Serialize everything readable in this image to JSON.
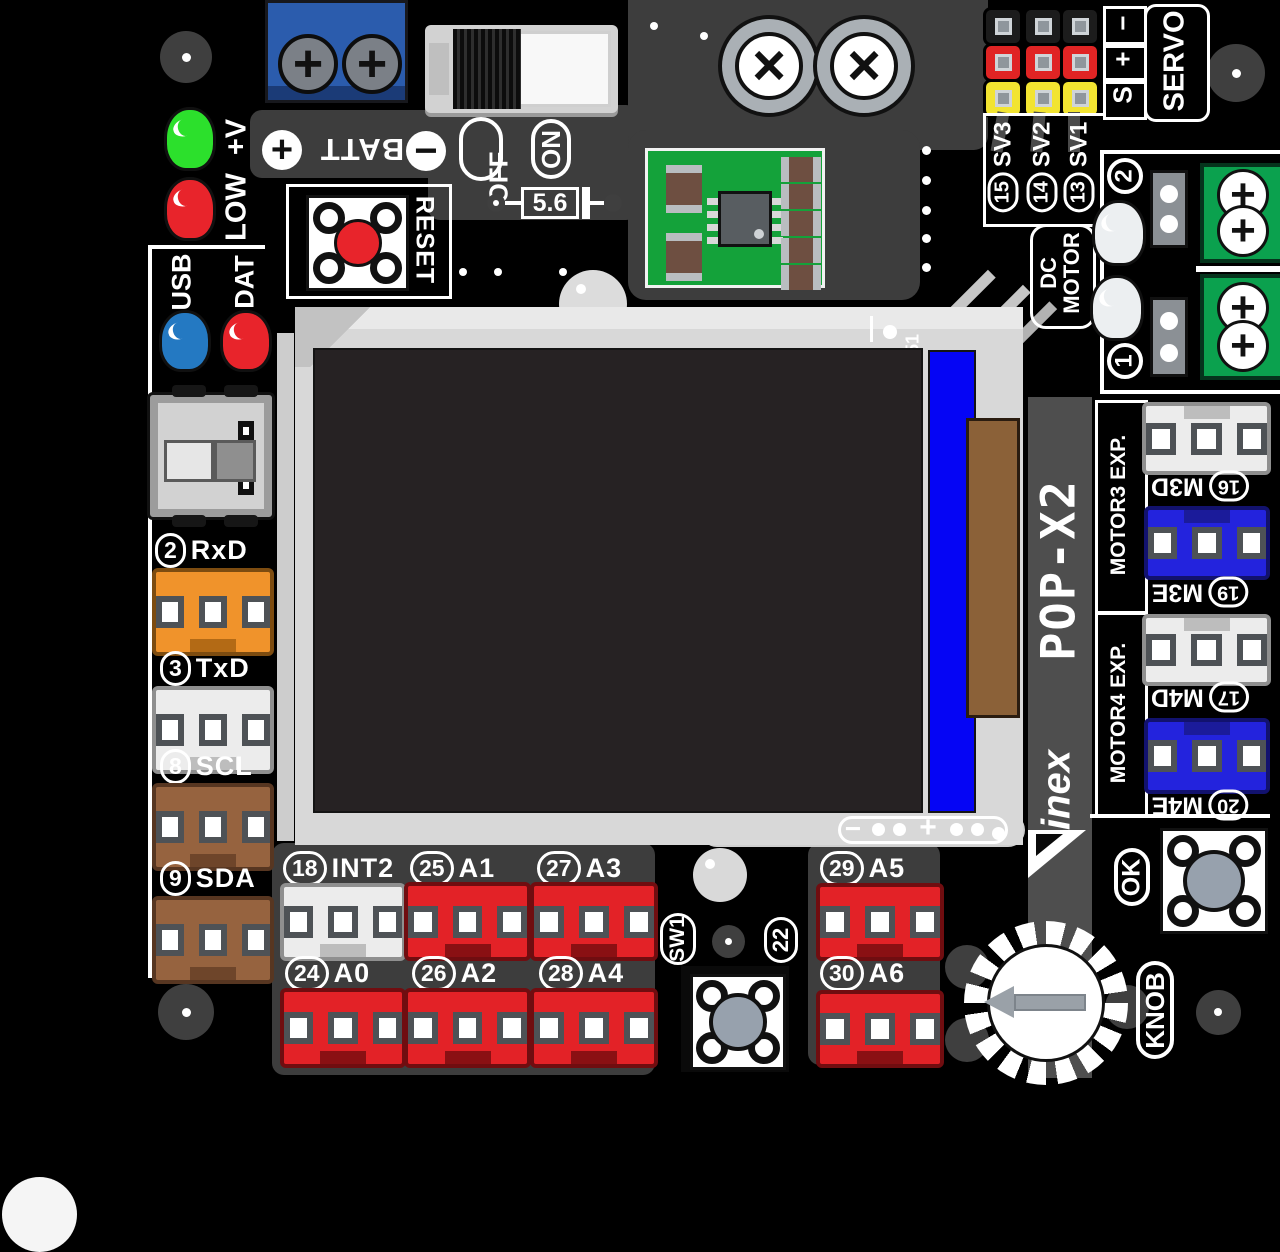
{
  "board": {
    "model": "POP-X2",
    "vendor": "inex",
    "lcd_pin": "51"
  },
  "icons": {
    "plus": "+",
    "minus": "−",
    "screw_cross": "+",
    "cap_cross": "×"
  },
  "power": {
    "batt": "BATT",
    "off": "OFF",
    "on": "ON",
    "diode_value": "5.6",
    "reset": "RESET"
  },
  "leds": {
    "vplus": "+V",
    "low": "LOW",
    "usb": "USB",
    "dat": "DAT"
  },
  "left_ports": [
    {
      "num": "2",
      "name": "RxD"
    },
    {
      "num": "3",
      "name": "TxD"
    },
    {
      "num": "8",
      "name": "SCL"
    },
    {
      "num": "9",
      "name": "SDA"
    }
  ],
  "servo": {
    "title": "SERVO",
    "pin_s": "S",
    "pin_plus": "+",
    "pin_minus": "−",
    "channels": [
      {
        "num": "15",
        "name": "SV3"
      },
      {
        "num": "14",
        "name": "SV2"
      },
      {
        "num": "13",
        "name": "SV1"
      }
    ]
  },
  "dc_motor": {
    "line1": "DC",
    "line2": "MOTOR",
    "ch_top": "2",
    "ch_bottom": "1"
  },
  "motor_exp": {
    "m3_title": "MOTOR3 EXP.",
    "m4_title": "MOTOR4 EXP.",
    "ports": [
      {
        "num": "16",
        "name": "M3D"
      },
      {
        "num": "19",
        "name": "M3E"
      },
      {
        "num": "17",
        "name": "M4D"
      },
      {
        "num": "20",
        "name": "M4E"
      }
    ]
  },
  "lcd_marks": {
    "minus": "−",
    "plus": "+"
  },
  "bottom_ports": [
    {
      "num": "18",
      "name": "INT2"
    },
    {
      "num": "25",
      "name": "A1"
    },
    {
      "num": "27",
      "name": "A3"
    },
    {
      "num": "29",
      "name": "A5"
    },
    {
      "num": "24",
      "name": "A0"
    },
    {
      "num": "26",
      "name": "A2"
    },
    {
      "num": "28",
      "name": "A4"
    },
    {
      "num": "30",
      "name": "A6"
    }
  ],
  "controls": {
    "ok": "OK",
    "knob": "KNOB",
    "sw1": "SW1",
    "sw1_pin": "22"
  },
  "colors": {
    "board": "#000000",
    "silk": "#ffffff",
    "panel": "#3d3d3d",
    "band": "#4e4e4e",
    "lcd_frame": "#d8d8d8",
    "screen": "#262223",
    "lcd_blue": "#0505f5",
    "flex_brown": "#8b6138",
    "conn_red": "#e32227",
    "conn_orange": "#f0932b",
    "conn_brown": "#96633f",
    "conn_blue": "#2323dd",
    "conn_white": "#ececec",
    "terminal_green": "#0ba14e",
    "terminal_blue": "#2b5cad",
    "led_green": "#2ce02c",
    "led_red": "#e8242b",
    "led_blue": "#2479c2",
    "led_white": "#eceff1",
    "pin_yellow": "#f2e431",
    "pin_red": "#e02424",
    "pin_black": "#1c1c1c"
  }
}
